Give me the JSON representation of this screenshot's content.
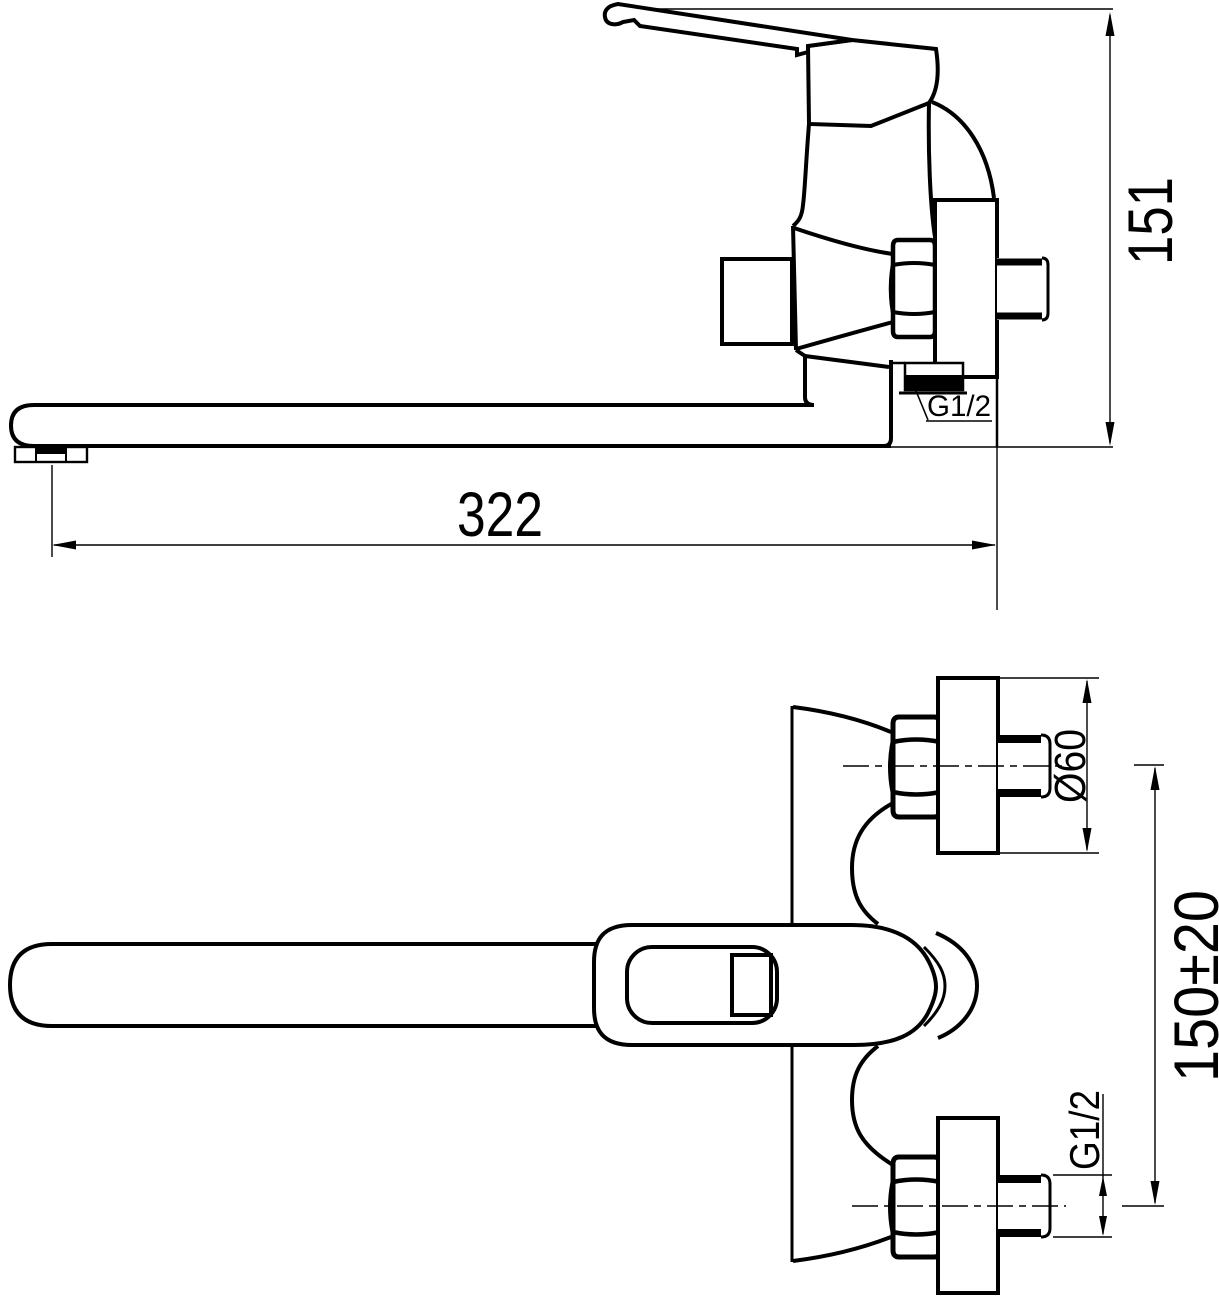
{
  "drawing": {
    "background": "#ffffff",
    "ink": "#000000",
    "side_view": {
      "dim_height": "151",
      "dim_length": "322",
      "thread_label": "G1/2"
    },
    "front_view": {
      "dim_flange_diameter": "Ø60",
      "dim_port_spacing": "150±20",
      "thread_label": "G1/2"
    }
  }
}
